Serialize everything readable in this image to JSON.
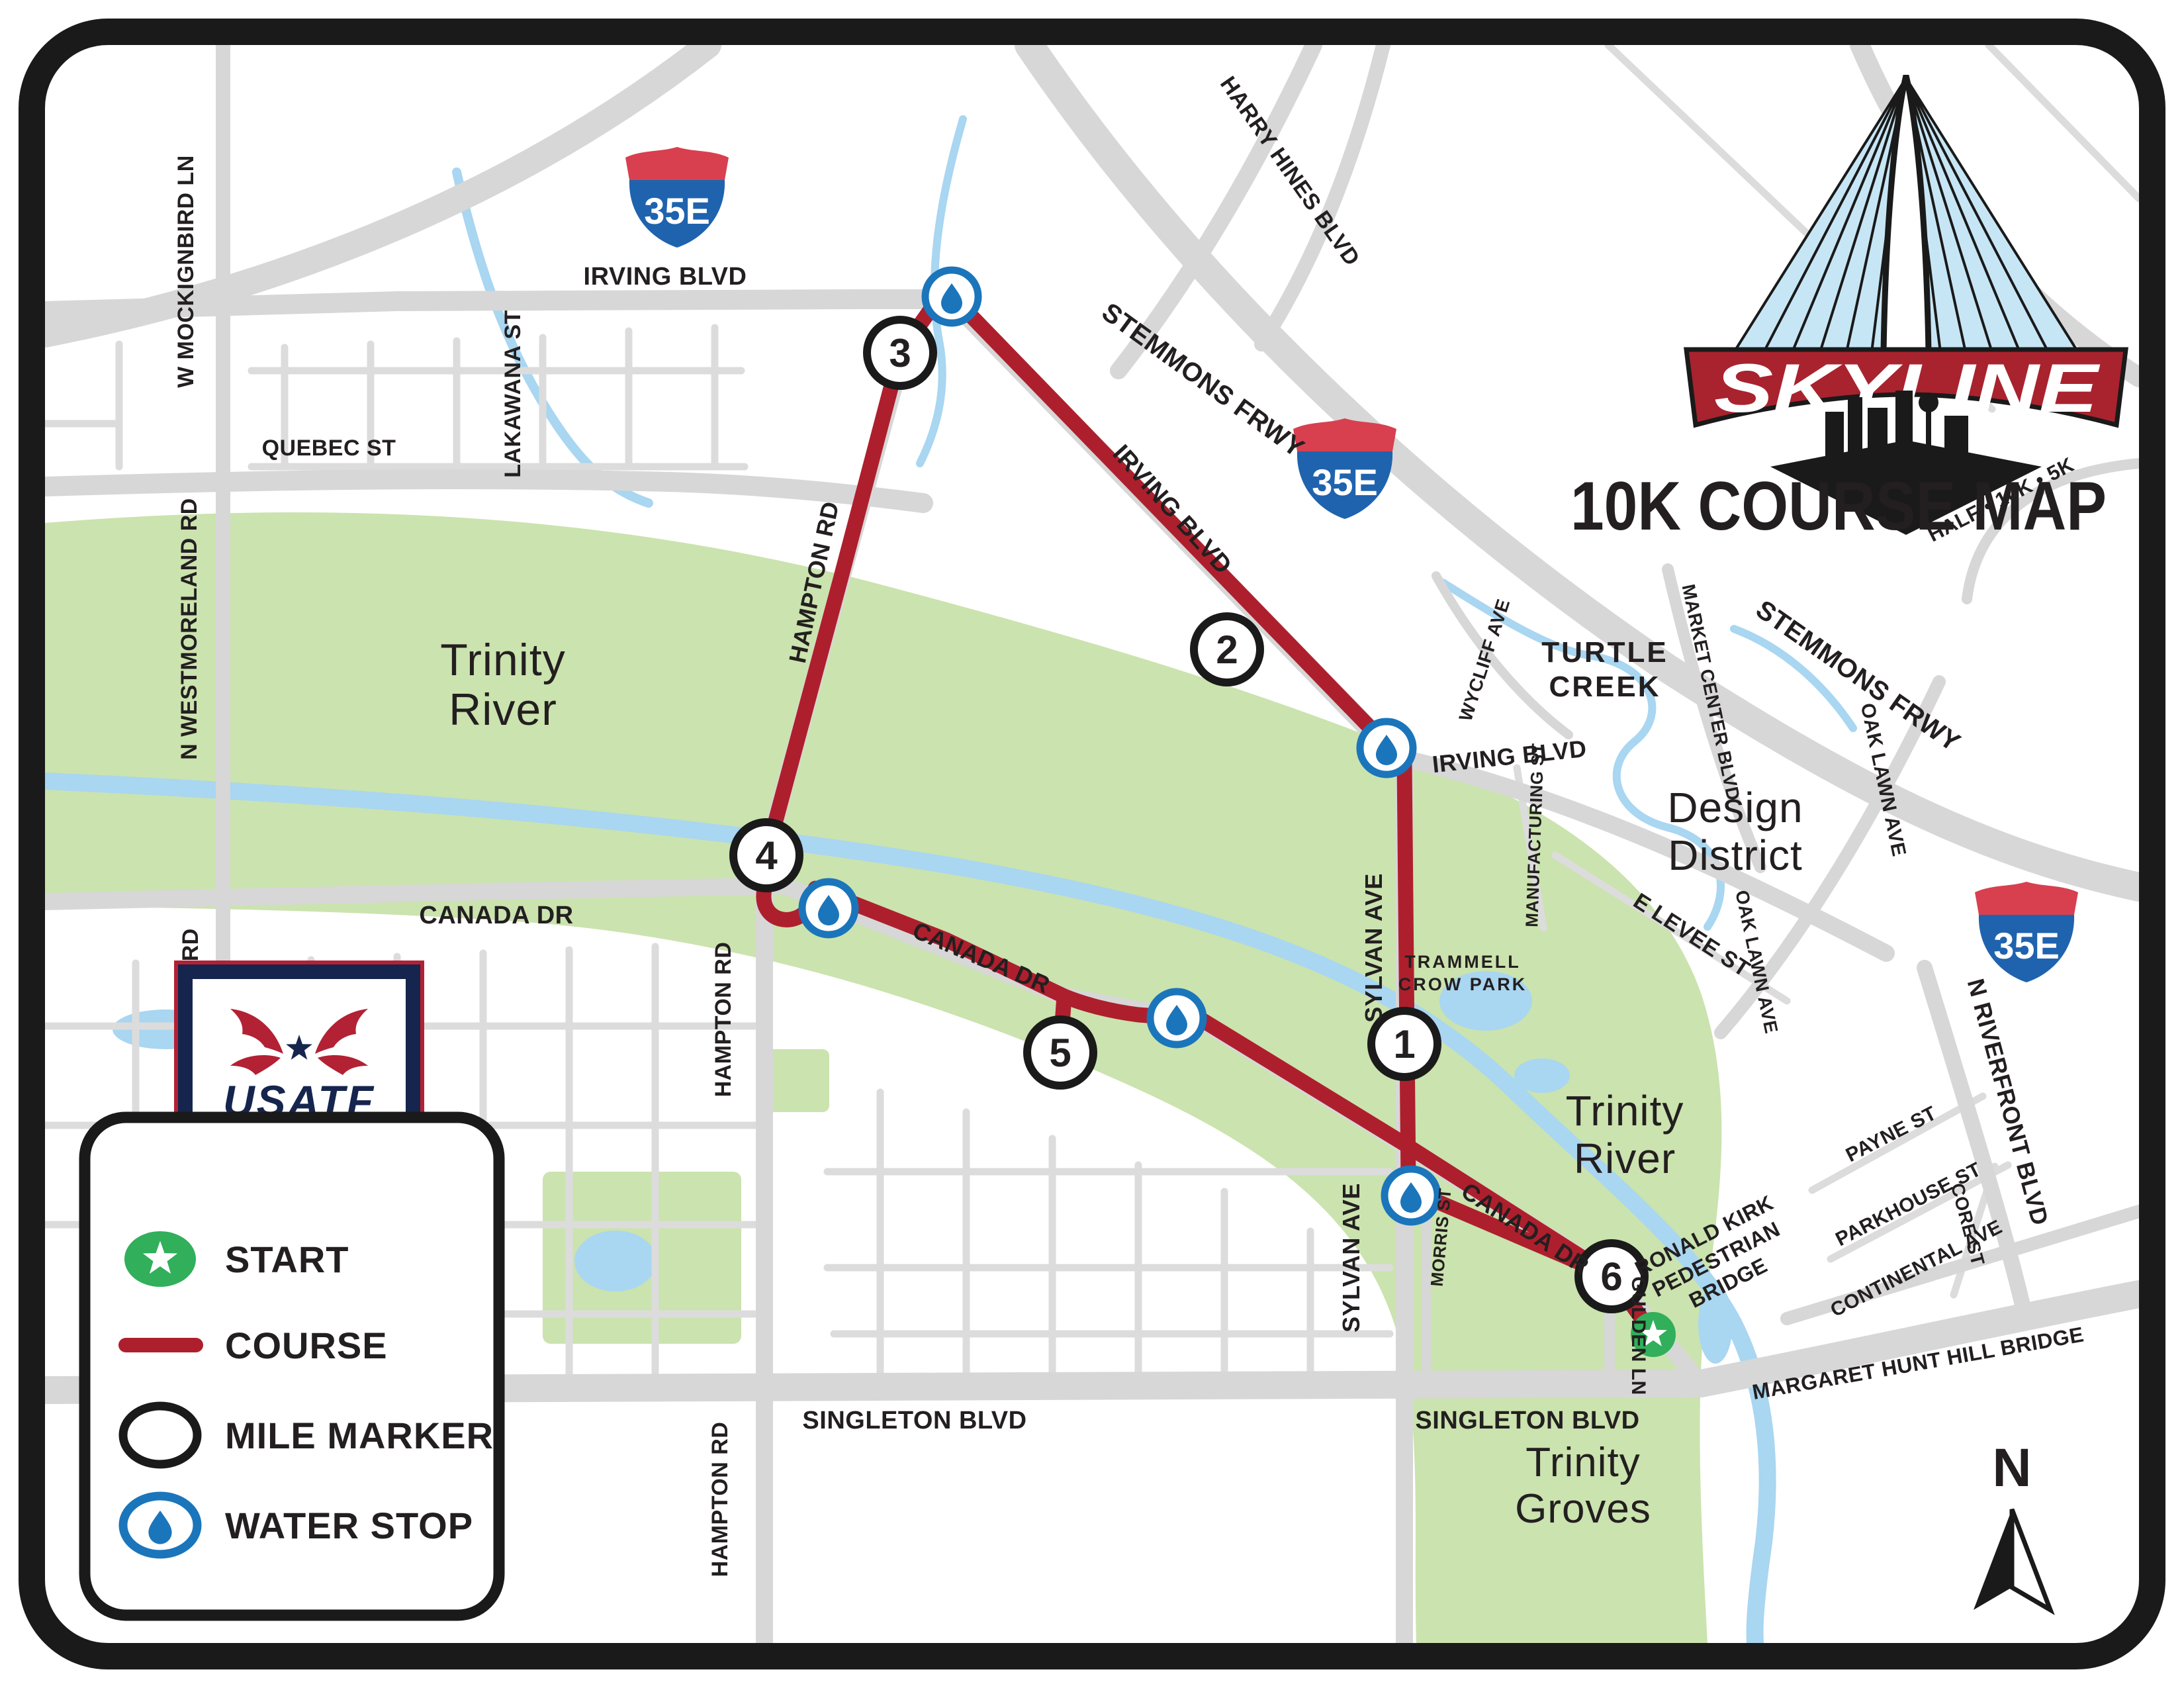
{
  "header": {
    "title": "10K COURSE MAP"
  },
  "logo": {
    "wordmark": "SKYLINE",
    "events": "HALF • 10K • 5K"
  },
  "badge": {
    "org": "USATF",
    "tagline": "CERTIFIED COURSE"
  },
  "legend": {
    "items": [
      {
        "icon": "start-star",
        "label": "START"
      },
      {
        "icon": "course-line",
        "label": "COURSE"
      },
      {
        "icon": "mile-circle",
        "label": "MILE MARKER"
      },
      {
        "icon": "water-drop",
        "label": "WATER STOP"
      }
    ]
  },
  "compass": {
    "label": "N"
  },
  "shields": {
    "i35e": "35E"
  },
  "course": {
    "mile_markers": [
      "1",
      "2",
      "3",
      "4",
      "5",
      "6"
    ],
    "water_stop_count": 5
  },
  "colors": {
    "course_red": "#ae1f2d",
    "title_red": "#c0272d",
    "banner_red": "#a8232e",
    "water_blue": "#1b75bb",
    "start_green": "#31af5b",
    "floodway_green": "#cbe3ae",
    "river_blue": "#a9d6f1",
    "road_gray": "#d7d7d7",
    "navy": "#15254d",
    "border_black": "#1a1a1a"
  },
  "streets": [
    {
      "text": "W MOCKIGNBIRD LN"
    },
    {
      "text": "QUEBEC ST"
    },
    {
      "text": "LAKAWANA ST"
    },
    {
      "text": "IRVING BLVD"
    },
    {
      "text": "HARRY HINES BLVD"
    },
    {
      "text": "STEMMONS FRWY"
    },
    {
      "text": "IRVING BLVD"
    },
    {
      "text": "N WESTMORELAND RD"
    },
    {
      "text": "WYCLIFF AVE"
    },
    {
      "text": "MARKET CENTER BLVD"
    },
    {
      "text": "STEMMONS FRWY"
    },
    {
      "text": "OAK LAWN AVE"
    },
    {
      "text": "IRVING BLVD"
    },
    {
      "text": "MANUFACTURING ST"
    },
    {
      "text": "E LEVEE ST"
    },
    {
      "text": "OAK LAWN AVE"
    },
    {
      "text": "SYLVAN AVE"
    },
    {
      "text": "CANADA DR"
    },
    {
      "text": "HAMPTON RD"
    },
    {
      "text": "HAMPTON RD"
    },
    {
      "text": "CANADA DR"
    },
    {
      "text": "MORRIS ST"
    },
    {
      "text": "SYLVAN AVE"
    },
    {
      "text": "CANADA DR"
    },
    {
      "text": "GULDEN LN"
    },
    {
      "text": "PAYNE ST"
    },
    {
      "text": "N RIVERFRONT BLVD"
    },
    {
      "text": "PARKHOUSE ST"
    },
    {
      "text": "CORE ST"
    },
    {
      "text": "CONTINENTAL AVE"
    },
    {
      "text": "SINGLETON BLVD"
    },
    {
      "text": "SINGLETON BLVD"
    },
    {
      "text": "HAMPTON RD"
    },
    {
      "text": "N WESTMORELAND RD"
    }
  ],
  "areas": [
    {
      "l1": "Trinity",
      "l2": "River"
    },
    {
      "l1": "Trinity",
      "l2": "River"
    },
    {
      "l1": "Design",
      "l2": "District"
    },
    {
      "l1": "Trinity",
      "l2": "Groves"
    },
    {
      "l1": "TURTLE",
      "l2": "CREEK"
    },
    {
      "l1": "TRAMMELL",
      "l2": "CROW PARK"
    }
  ],
  "bridges": [
    {
      "l1": "RONALD KIRK",
      "l2": "PEDESTRIAN",
      "l3": "BRIDGE"
    },
    {
      "l1": "MARGARET HUNT HILL BRIDGE"
    }
  ]
}
